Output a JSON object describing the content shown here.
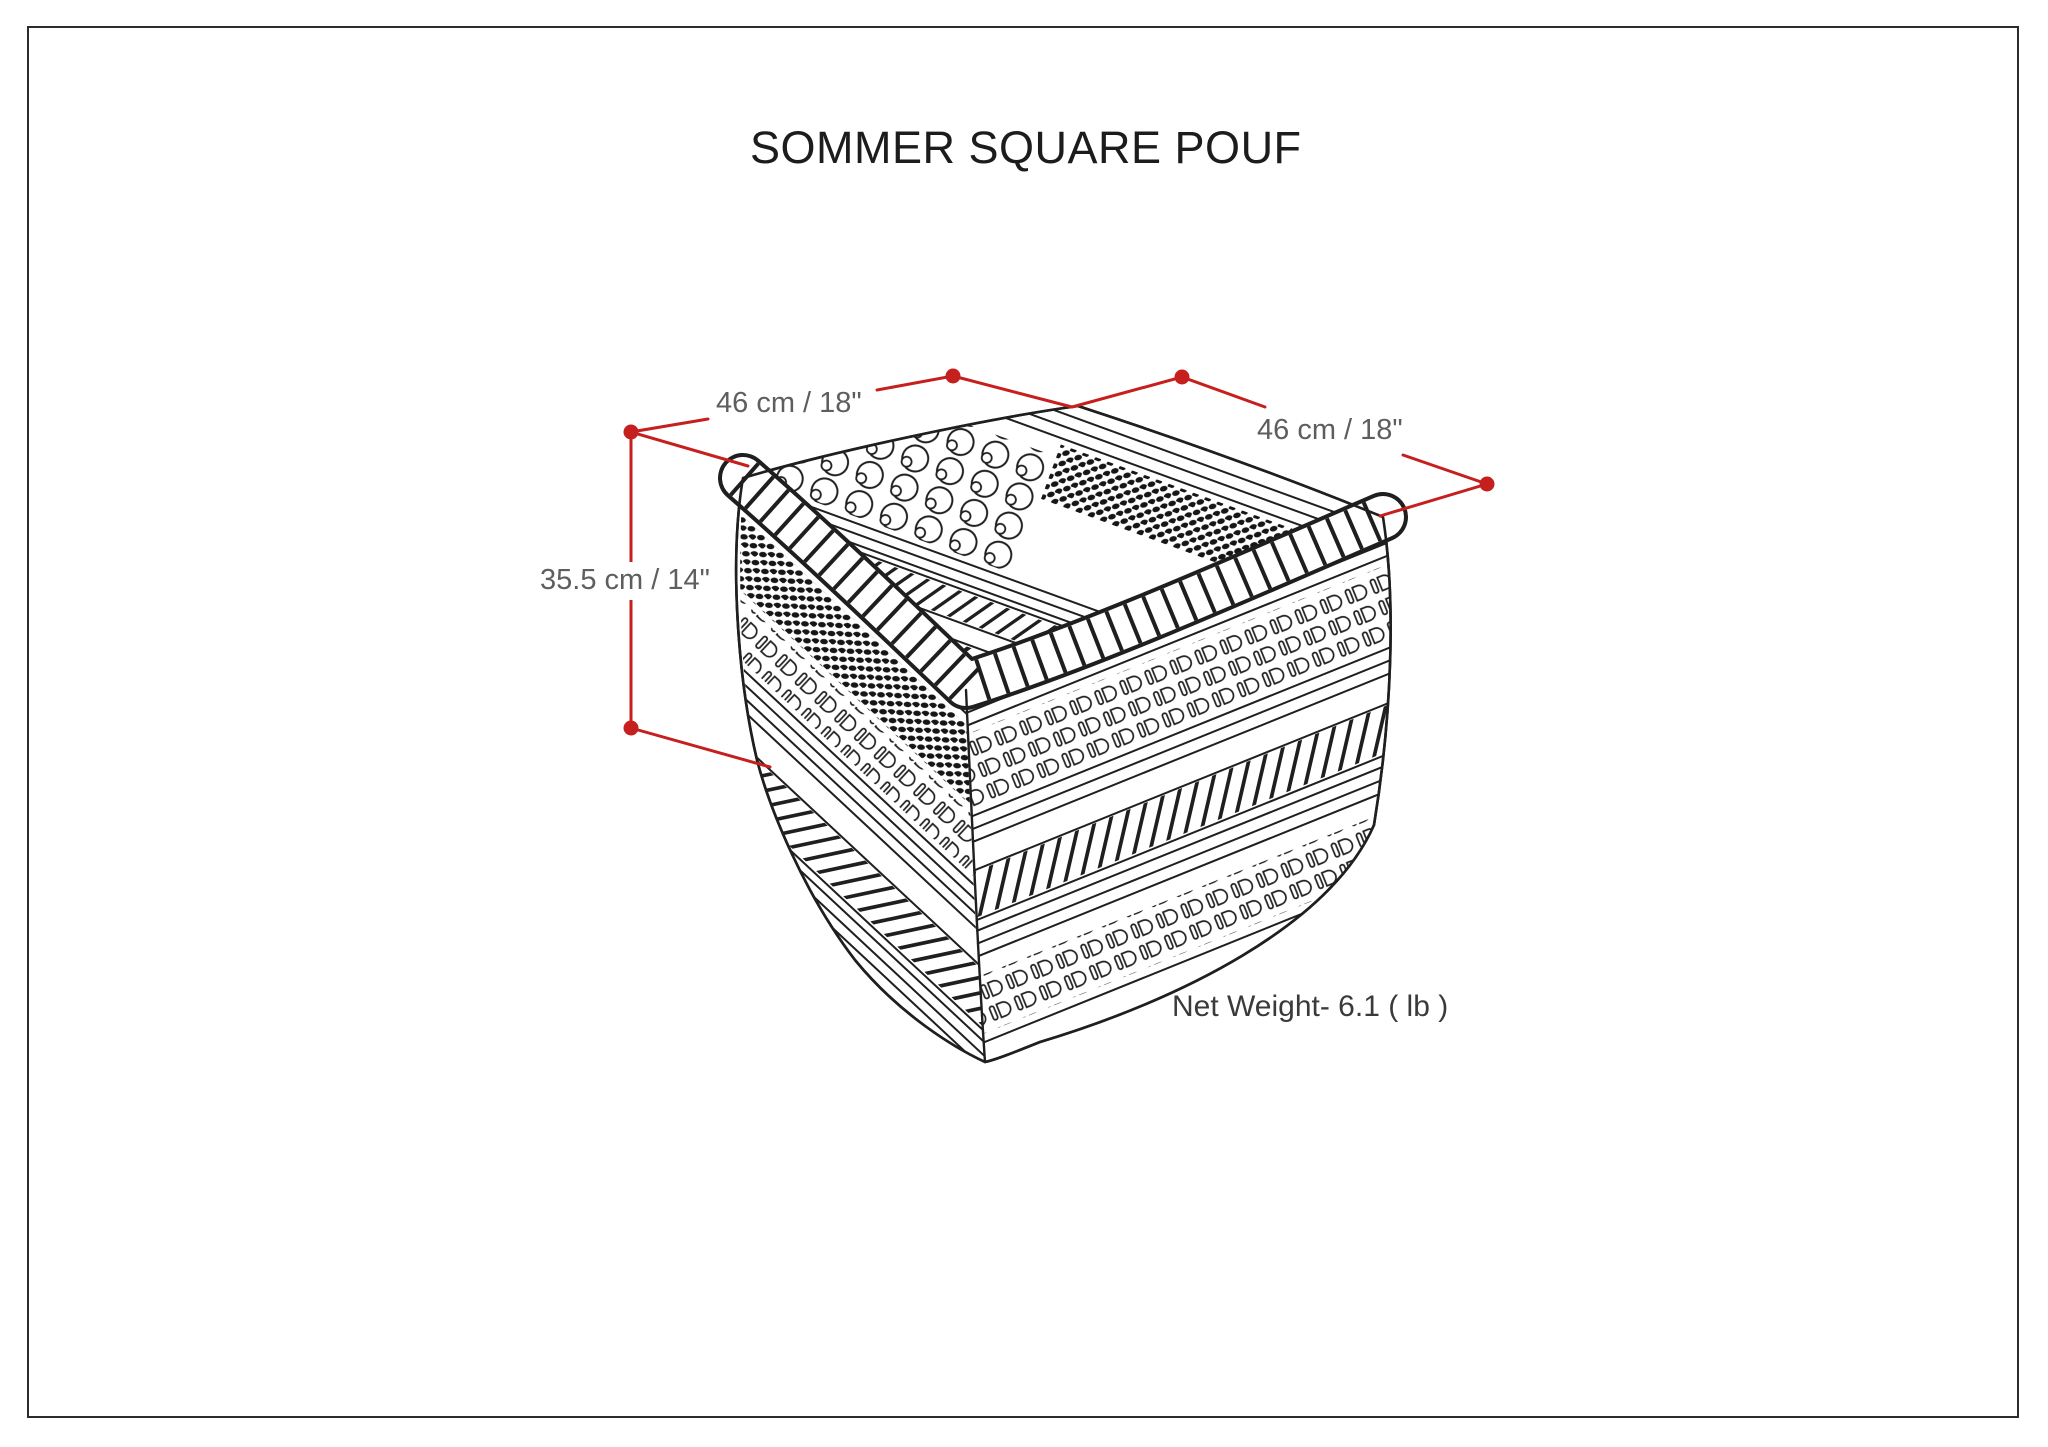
{
  "title": "SOMMER SQUARE POUF",
  "dimensions": {
    "width_label": "46 cm / 18\"",
    "depth_label": "46 cm / 18\"",
    "height_label": "35.5 cm / 14\""
  },
  "net_weight_label": "Net Weight- 6.1 ( lb )",
  "colors": {
    "background": "#ffffff",
    "page_border": "#2c2c2c",
    "title_text": "#1c1c1c",
    "dimension_text": "#5e5e5e",
    "net_weight_text": "#3a3a3a",
    "dimension_line_red": "#c6201e",
    "drawing_ink": "#1f1f1f"
  },
  "drawing": {
    "subject": "sommer-square-pouf-line-drawing",
    "textures": [
      "bobbles",
      "rope-braid",
      "loop-stitch-rows",
      "dark-speckle-bands",
      "thin-line-stripes"
    ]
  }
}
